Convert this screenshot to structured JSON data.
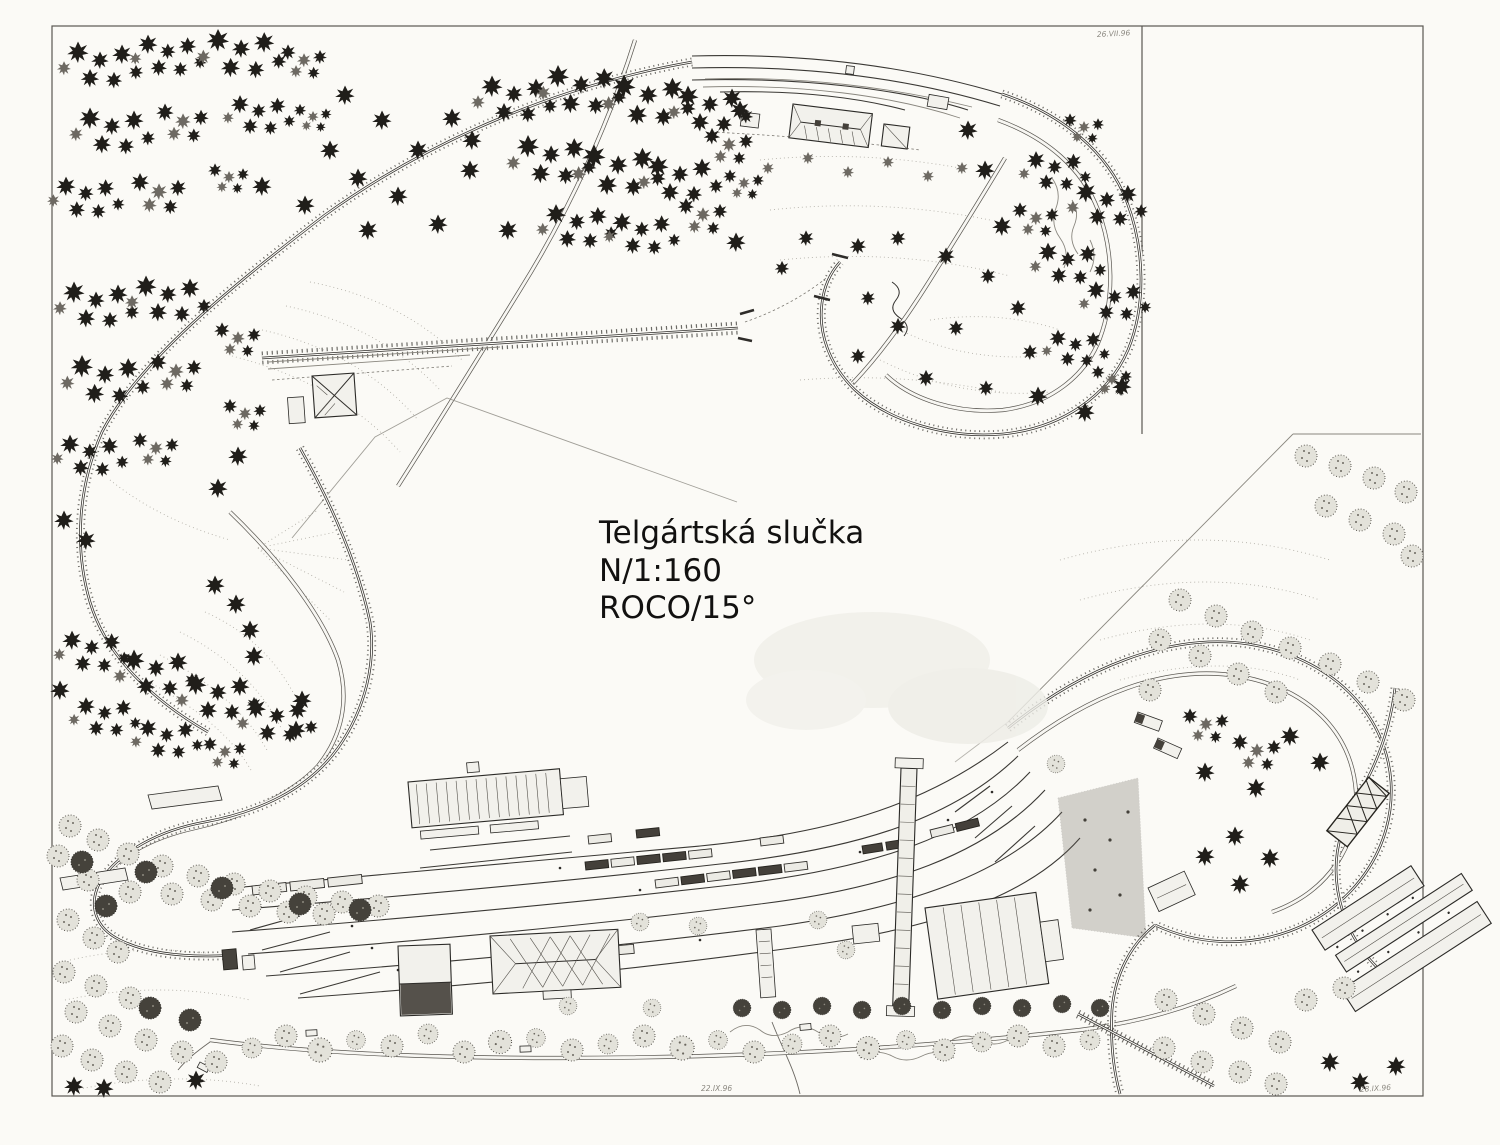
{
  "page": {
    "description": "Scanned hand-drawn N-scale model railway track plan with forests, loops, viaduct and a large station yard",
    "paper_color": "#fbfaf6",
    "ink_color": "#2e2c29"
  },
  "title_block": {
    "layout_name": "Telgártská slučka",
    "scale_line": "N/1:160",
    "system_line": "ROCO/15°"
  },
  "handwritten_marks": {
    "top_right_note": "26.VII.96",
    "bottom_center_note": "22.IX.96",
    "bottom_right_note": "28.IX.96"
  }
}
